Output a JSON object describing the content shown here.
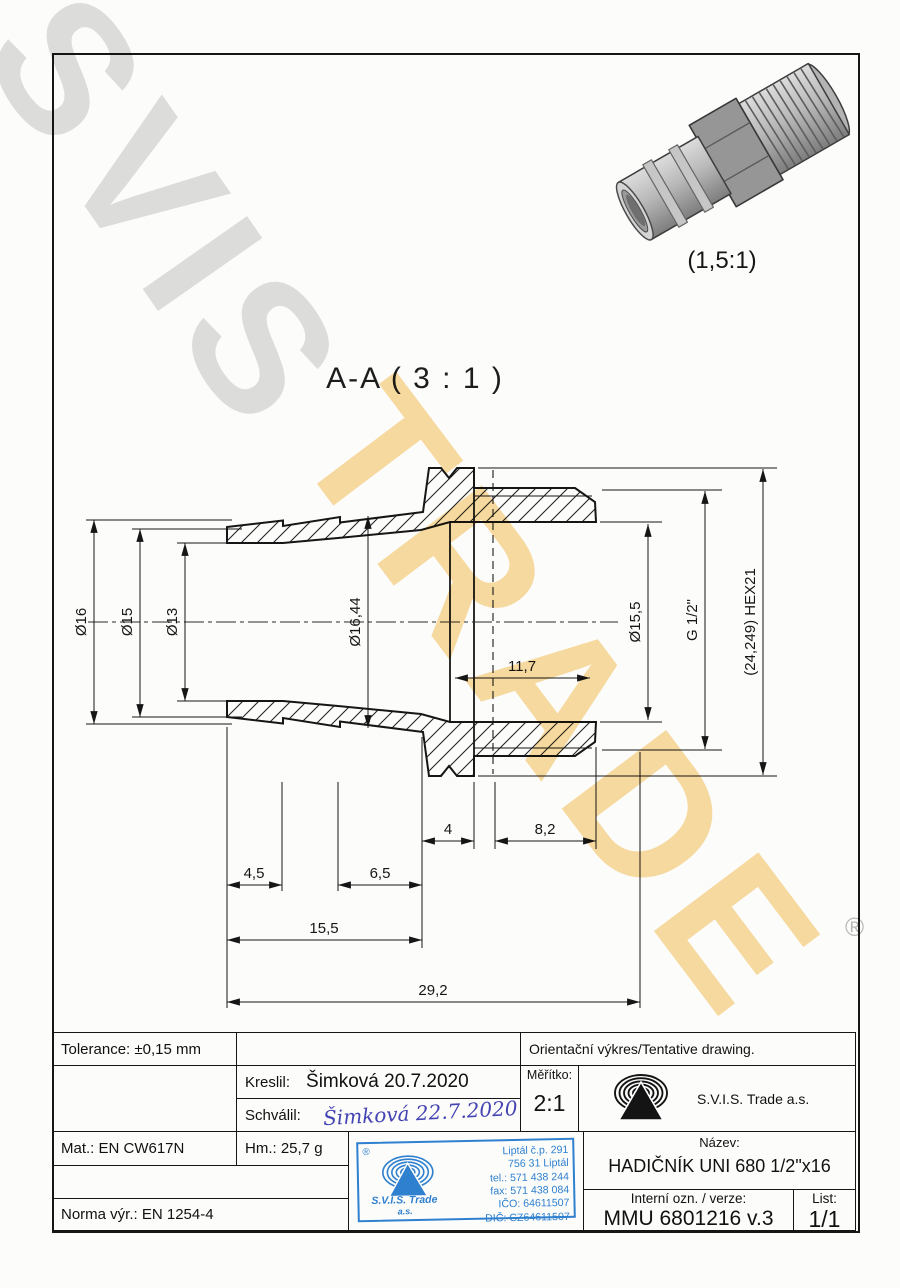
{
  "watermark": {
    "gray": "SVIS",
    "orange": "TRADE",
    "registered": "®"
  },
  "view3d": {
    "scale_label": "(1,5:1)"
  },
  "section": {
    "title": "A-A ( 3 : 1 )"
  },
  "dims": {
    "d16": "Ø16",
    "d15": "Ø15",
    "d13": "Ø13",
    "d1644": "Ø16,44",
    "d155": "Ø15,5",
    "g12": "G 1/2\"",
    "hex": "(24,249) HEX21",
    "l117": "11,7",
    "l4": "4",
    "l82": "8,2",
    "l45": "4,5",
    "l65": "6,5",
    "l155": "15,5",
    "l292": "29,2"
  },
  "titleblock": {
    "tolerance": "Tolerance: ±0,15 mm",
    "orientacni": "Orientační výkres/Tentative drawing.",
    "kreslil_label": "Kreslil:",
    "kreslil_value": "Šimková 20.7.2020",
    "schvalil_label": "Schválil:",
    "schvalil_value": "Šimková 22.7.2020",
    "meritko_label": "Měřítko:",
    "meritko_value": "2:1",
    "company": "S.V.I.S. Trade a.s.",
    "mat": "Mat.: EN CW617N",
    "hm": "Hm.: 25,7 g",
    "norma": "Norma výr.: EN 1254-4",
    "nazev_label": "Název:",
    "nazev_value": "HADIČNÍK UNI 680 1/2\"x16",
    "interni_label": "Interní ozn. / verze:",
    "interni_value": "MMU 6801216 v.3",
    "list_label": "List:",
    "list_value": "1/1"
  },
  "stamp": {
    "reg": "®",
    "company": "S.V.I.S. Trade",
    "as": "a.s.",
    "lines": [
      "Liptál č.p. 291",
      "756 31 Liptál",
      "tel.: 571 438 244",
      "fax: 571 438 084",
      "IČO: 64611507",
      "DIČ: CZ64611507"
    ]
  }
}
